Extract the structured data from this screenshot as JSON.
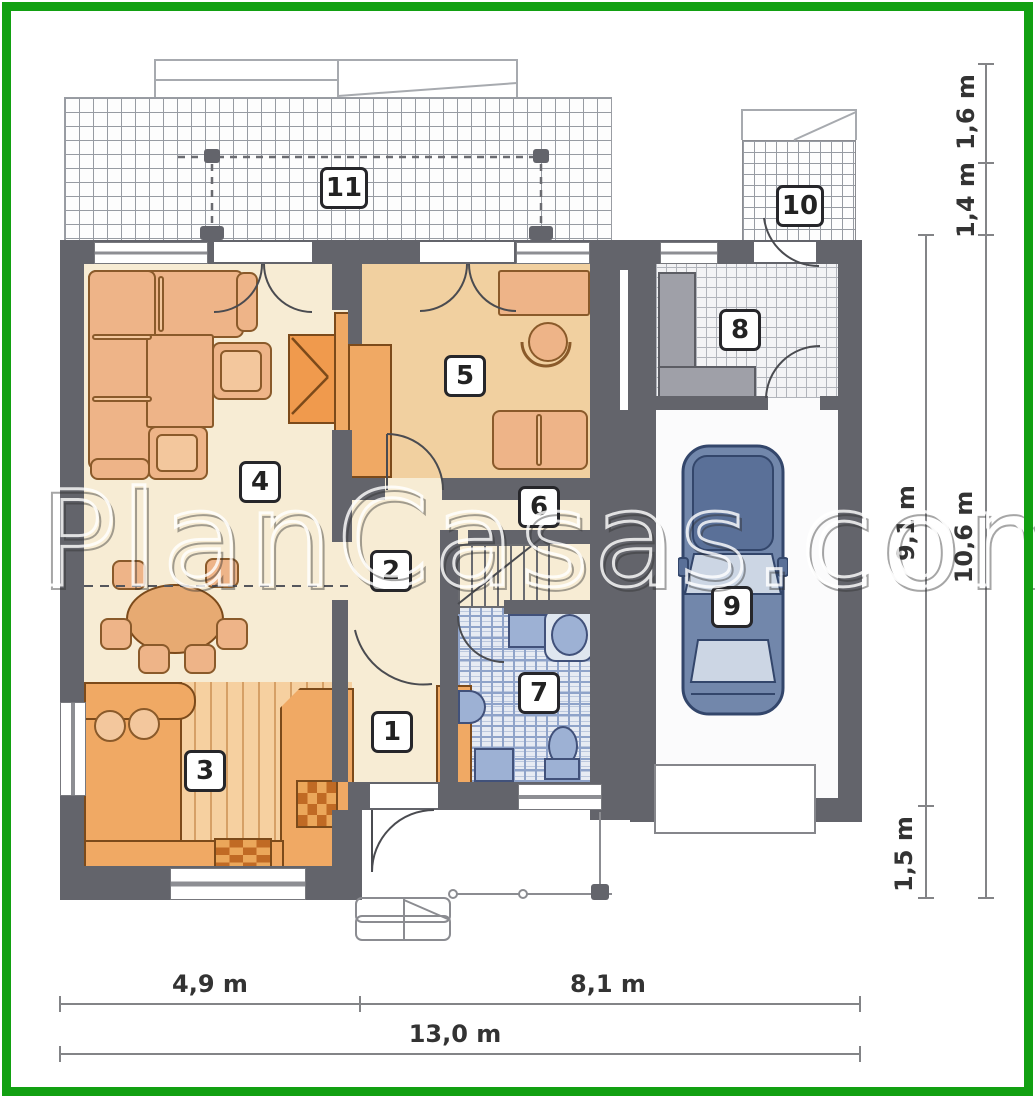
{
  "watermark": {
    "text": "PlanCasas.com"
  },
  "room_labels": {
    "r1": "1",
    "r2": "2",
    "r3": "3",
    "r4": "4",
    "r5": "5",
    "r6": "6",
    "r7": "7",
    "r8": "8",
    "r9": "9",
    "r10": "10",
    "r11": "11"
  },
  "dimensions": {
    "bottom_left": "4,9 m",
    "bottom_right": "8,1 m",
    "bottom_total": "13,0 m",
    "right_top_upper": "1,6 m",
    "right_top_lower": "1,4 m",
    "right_main": "9,1 m",
    "right_total": "10,6 m",
    "right_porch": "1,5 m"
  },
  "colors": {
    "frame_green": "#12a012",
    "wall_gray": "#63646b",
    "floor_cream": "#f7ecd4",
    "floor_tan": "#f1d0a0",
    "furniture_orange": "#eeb488",
    "counter_orange": "#f0a964",
    "bath_fixture_blue": "#9db1d4",
    "car_body_blue": "#7287ab"
  }
}
